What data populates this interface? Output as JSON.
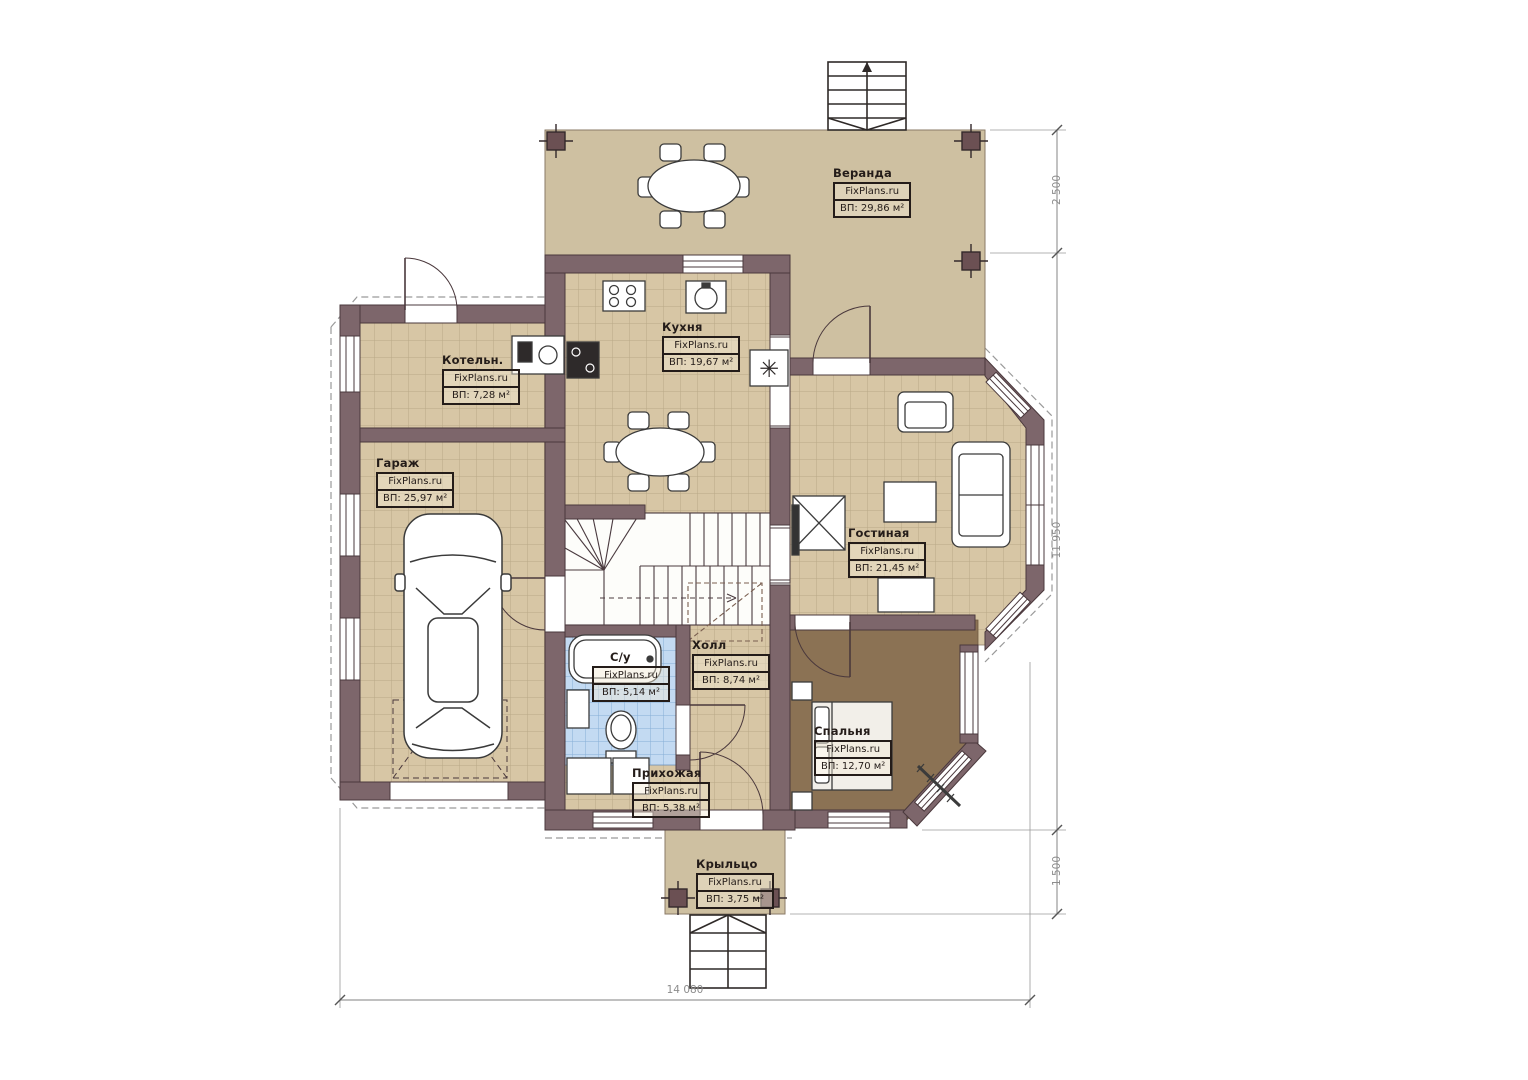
{
  "plan": {
    "watermark": "FixPlans.ru",
    "rooms": [
      {
        "name": "Веранда",
        "area": "ВП: 29,86 м²"
      },
      {
        "name": "Кухня",
        "area": "ВП: 19,67 м²"
      },
      {
        "name": "Котельн.",
        "area": "ВП: 7,28 м²"
      },
      {
        "name": "Гараж",
        "area": "ВП: 25,97 м²"
      },
      {
        "name": "Гостиная",
        "area": "ВП: 21,45 м²"
      },
      {
        "name": "Холл",
        "area": "ВП: 8,74 м²"
      },
      {
        "name": "С/у",
        "area": "ВП: 5,14 м²"
      },
      {
        "name": "Спальня",
        "area": "ВП: 12,70 м²"
      },
      {
        "name": "Прихожая",
        "area": "ВП: 5,38 м²"
      },
      {
        "name": "Крыльцо",
        "area": "ВП: 3,75 м²"
      }
    ],
    "dimensions": {
      "veranda_depth": "2 500",
      "house_height": "11 950",
      "porch_depth": "1 500",
      "house_width": "14 080"
    },
    "icons": {
      "vent": "✳"
    },
    "colors": {
      "wall": "#7d666b",
      "floor_tile": "#d7c6a5",
      "veranda_floor": "#cec0a1",
      "bedroom_floor": "#8b7254",
      "bath_tile": "#c3daf2"
    }
  }
}
